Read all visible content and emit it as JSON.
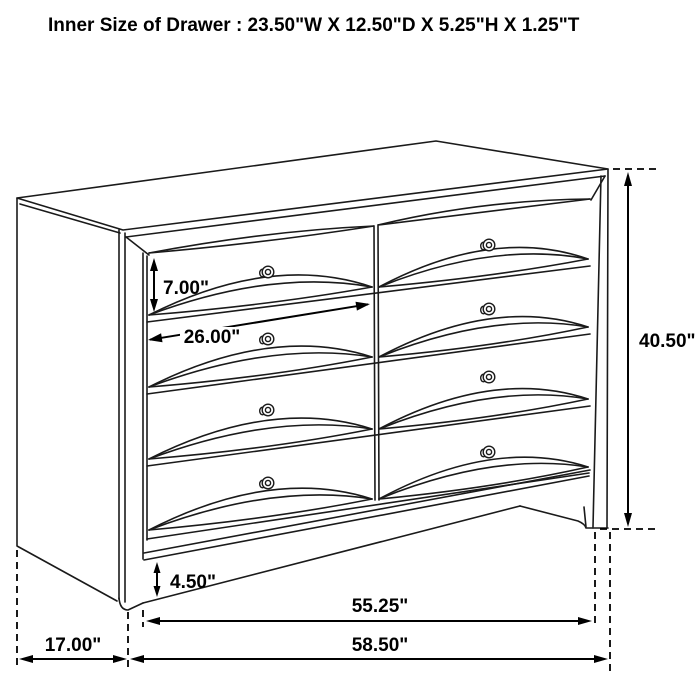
{
  "title": "Inner Size of Drawer : 23.50\"W X 12.50\"D X 5.25\"H X 1.25\"T",
  "diagram": {
    "type": "furniture-dimension-line-drawing",
    "subject": "eight-drawer-dresser",
    "drawer_rows": 4,
    "drawer_columns": 2,
    "knob_count": 8,
    "line_color": "#000000",
    "background_color": "#ffffff",
    "dimensions": {
      "drawer_front_height": "7.00\"",
      "drawer_front_width": "26.00\"",
      "overall_height": "40.50\"",
      "base_height": "4.50\"",
      "front_span": "55.25\"",
      "overall_width": "58.50\"",
      "depth": "17.00\""
    }
  }
}
